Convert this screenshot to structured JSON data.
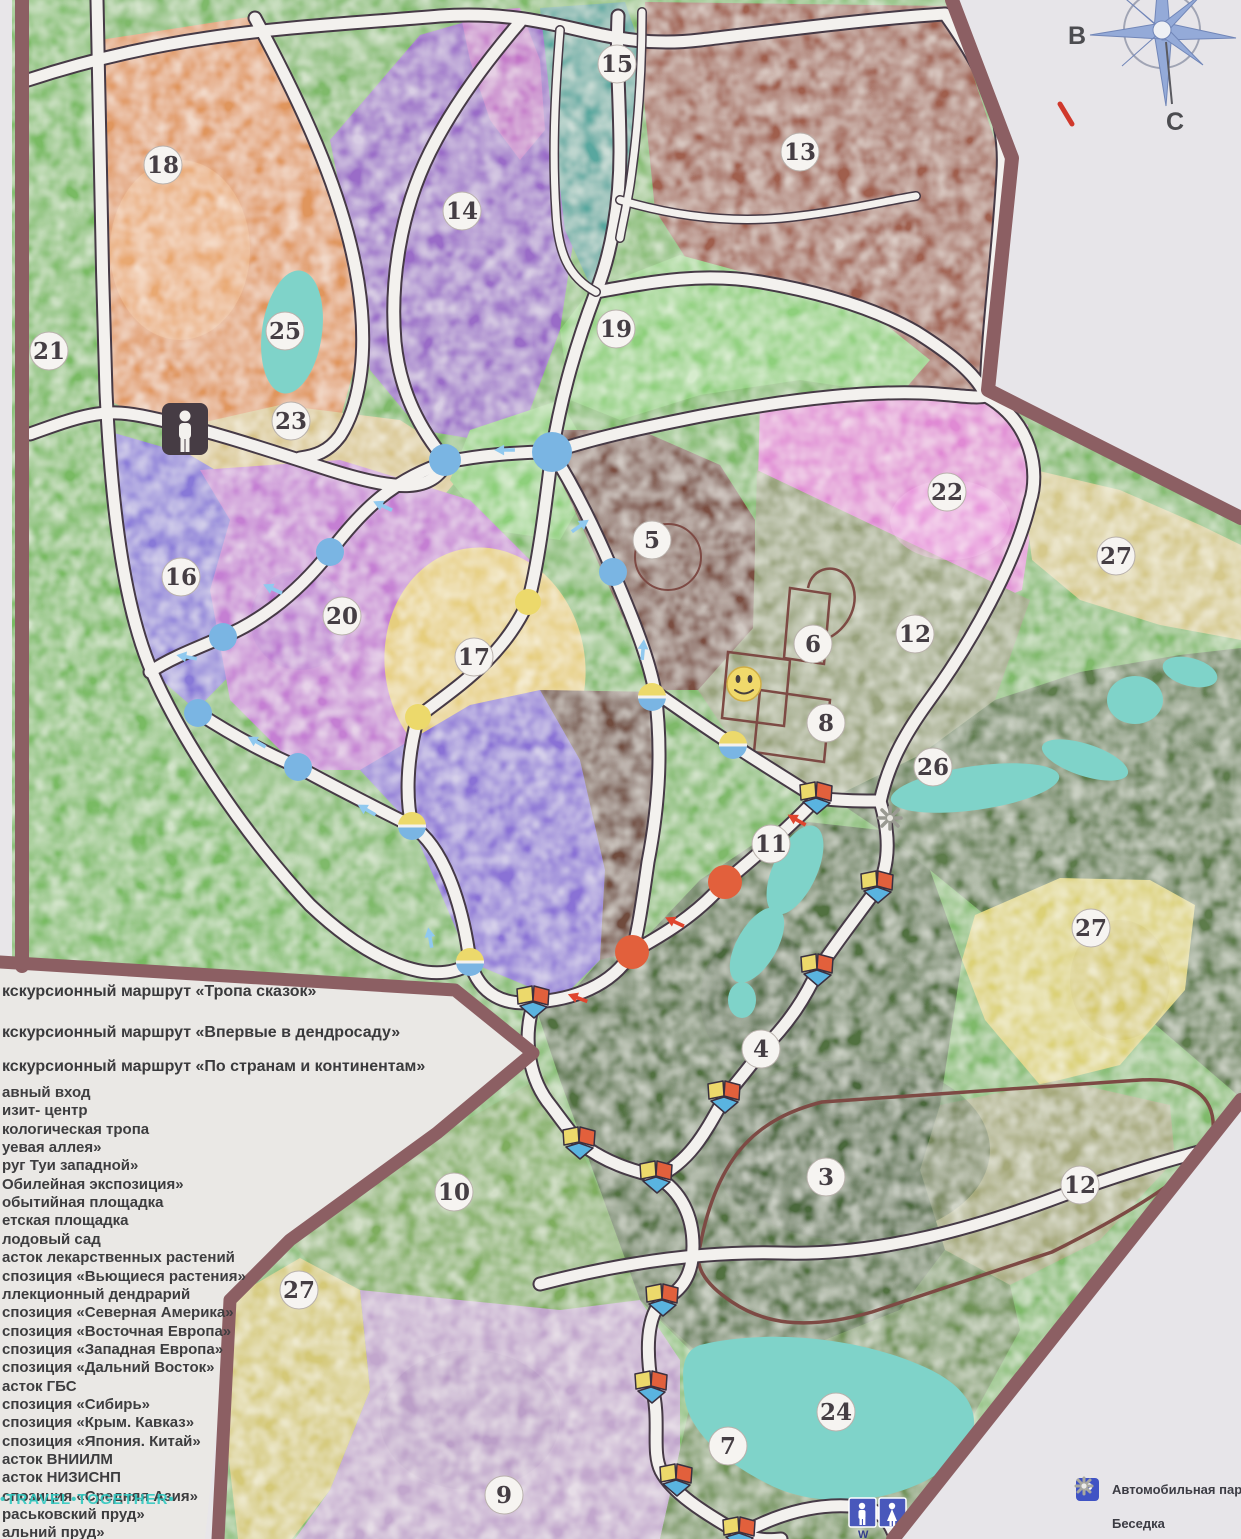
{
  "compass": {
    "labels": [
      "В",
      "С"
    ]
  },
  "map": {
    "wc_text": "W C",
    "zone_labels": [
      "15",
      "13",
      "18",
      "14",
      "19",
      "25",
      "21",
      "23",
      "22",
      "27",
      "5",
      "16",
      "12",
      "6",
      "20",
      "17",
      "8",
      "26",
      "11",
      "27",
      "4",
      "10",
      "3",
      "12",
      "27",
      "24",
      "7",
      "9"
    ]
  },
  "legend": {
    "routes": [
      "кскурсионный маршрут «Тропа сказок»",
      "кскурсионный маршрут «Впервые в дендросаду»",
      "кскурсионный маршрут «По странам и континентам»"
    ],
    "items": [
      "авный вход",
      "изит- центр",
      "кологическая тропа",
      "уевая аллея»",
      "руг Туи западной»",
      "Обилейная экспозиция»",
      "обытийная площадка",
      "етская площадка",
      "лодовый сад",
      "асток лекарственных растений",
      "спозиция «Вьющиеся растения»",
      "ллекционный дендрарий",
      "спозиция «Северная Америка»",
      "спозиция «Восточная Европа»",
      "спозиция «Западная Европа»",
      "спозиция «Дальний Восток»",
      "асток ГБС",
      "спозиция «Сибирь»",
      "спозиция «Крым. Кавказ»",
      "спозиция «Япония. Китай»",
      "асток ВНИИЛМ",
      "асток НИЗИСНП",
      "спозиция «Средняя Азия»",
      "раськовский пруд»",
      "альний пруд»"
    ]
  },
  "legend_right": {
    "parking_icon_letter": "P",
    "parking_label": "Автомобильная парко",
    "gazebo_label": "Беседка"
  },
  "watermark": "•TRAVEL•TOGETHER•",
  "colors": {
    "border": "#8c5f63",
    "path_white": "#f3f1ee",
    "route_blue": "#7ab5e3",
    "route_yellow": "#ecd96b",
    "route_red": "#e2603c",
    "pond": "#7fd3c9"
  }
}
